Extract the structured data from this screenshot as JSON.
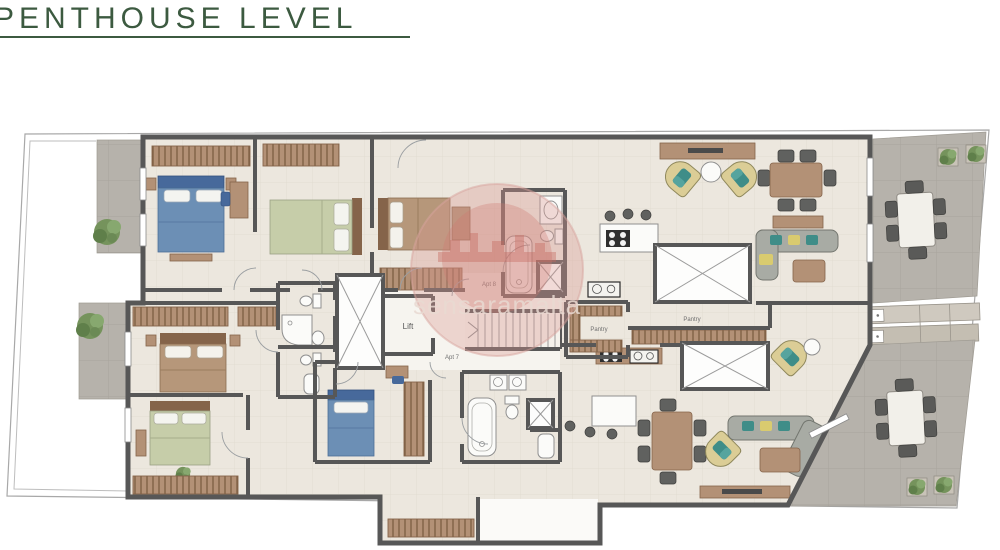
{
  "title": "PENTHOUSE LEVEL",
  "watermark": {
    "text": "sensaramalta"
  },
  "plan": {
    "labels": {
      "lift": "Lift",
      "apt8": "Apt 8",
      "apt7": "Apt 7",
      "pantry_upper": "Pantry",
      "pantry_lower": "Pantry"
    }
  },
  "colors": {
    "title-green": "#3c5a40",
    "wall": "#575757",
    "floor": "#ece7de",
    "floor-line": "#e2dcd1",
    "terrace": "#b6b2ab",
    "terrace-line": "#a8a49c",
    "wood": "#b39176",
    "wood-dark": "#85644a",
    "bed-blue": "#6c8fb5",
    "bed-blue-dark": "#47699b",
    "bed-green": "#c6cda9",
    "bed-tan": "#b6977a",
    "sofa": "#a8aba4",
    "chair": "#60615f",
    "fixture": "#fbfbf9",
    "plant": "#75935c",
    "watermark-red": "#c5534b",
    "label": "#6f6f6f"
  }
}
